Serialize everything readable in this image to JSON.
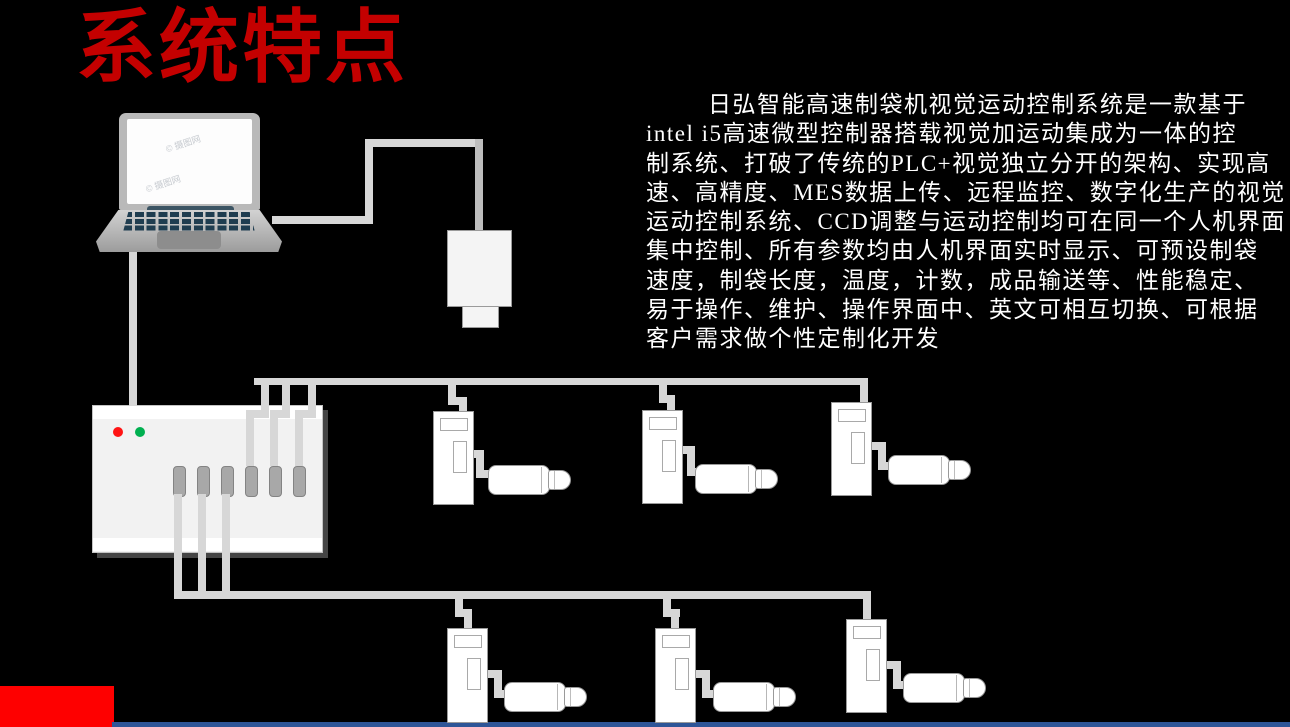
{
  "slide": {
    "title": "系统特点",
    "description_lines": [
      "日弘智能高速制袋机视觉运动控制系统是一款基于",
      "intel i5高速微型控制器搭载视觉加运动集成为一体的控",
      "制系统、打破了传统的PLC+视觉独立分开的架构、实现高",
      "速、高精度、MES数据上传、远程监控、数字化生产的视觉",
      "运动控制系统、CCD调整与运动控制均可在同一个人机界面",
      "集中控制、所有参数均由人机界面实时显示、可预设制袋",
      "速度，制袋长度，温度，计数，成品输送等、性能稳定、",
      "易于操作、维护、操作界面中、英文可相互切换、可根据",
      "客户需求做个性定制化开发"
    ],
    "watermark": "© 摄图网"
  },
  "colors": {
    "background": "#000000",
    "title_red": "#c40000",
    "accent_red": "#fe0000",
    "footer_blue": "#2e5597",
    "text_white": "#ffffff",
    "cable_gray": "#d7d7d7",
    "cable_dark_gray": "#bdbdbd",
    "device_fill": "#ffffff",
    "panel_fill": "#f2f2f2",
    "device_border": "#9a9a9a",
    "port_gray": "#a8a8a8",
    "led_red": "#ff1414",
    "led_green": "#00b050",
    "laptop_key_color": "#1f3d50"
  },
  "diagram": {
    "controller_port_count": 6,
    "controller_led_count": 2,
    "top_row_drive_count": 3,
    "bottom_row_drive_count": 3,
    "motor_count": 6
  }
}
